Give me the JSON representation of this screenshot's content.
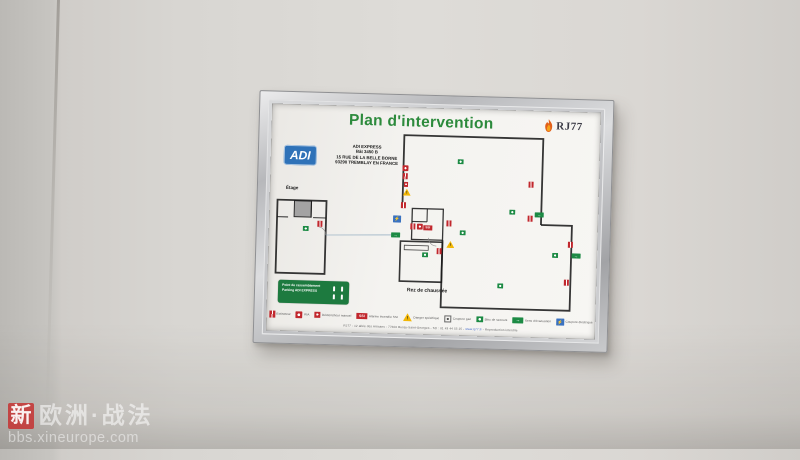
{
  "watermark": {
    "badge": "新",
    "title": "欧洲·战法",
    "site": "bbs.xineurope.com"
  },
  "poster": {
    "title": "Plan d'intervention",
    "brand": {
      "name": "RJ77"
    },
    "site_block": {
      "logo": "ADI",
      "lines": [
        "ADI EXPRESS",
        "Bât 3450 B",
        "15 RUE DE LA BELLE BORNE",
        "93290 TREMBLAY EN FRANCE"
      ]
    },
    "labels": {
      "upper_floor": "Étage",
      "ground_floor": "Rez de chaussée"
    },
    "assembly_box": {
      "line1": "Point de rassemblement",
      "line2": "Parking ADI EXPRESS"
    },
    "legend": {
      "items": [
        {
          "id": "extinguisher",
          "label": "Extincteur"
        },
        {
          "id": "hose-reel",
          "label": "RIA"
        },
        {
          "id": "manual-call-point",
          "label": "Déclencheur manuel"
        },
        {
          "id": "ssi",
          "label": "Alarme incendie SSI"
        },
        {
          "id": "danger",
          "label": "Danger spécifique"
        },
        {
          "id": "gas-cutoff",
          "label": "Coupure gaz"
        },
        {
          "id": "emergency-block",
          "label": "Bloc de secours"
        },
        {
          "id": "evacuation-direction",
          "label": "Sens d'évacuation"
        },
        {
          "id": "electric-cutoff",
          "label": "Coupure électrique"
        }
      ]
    },
    "footer": {
      "prefix": "RJ77 - 12 allée des Artisans - 77600 Bussy-Saint-Georges - Tél : 01 43 44 55 25 - ",
      "link": "www.rj77.fr",
      "suffix": " - Reproduction interdite"
    },
    "plan_markers": [
      {
        "t": "ext",
        "x": 51,
        "y": 119
      },
      {
        "t": "block",
        "x": 37,
        "y": 124
      },
      {
        "t": "block",
        "x": 190,
        "y": 53
      },
      {
        "t": "ria",
        "x": 135,
        "y": 61
      },
      {
        "t": "ext",
        "x": 135,
        "y": 69
      },
      {
        "t": "dm",
        "x": 136,
        "y": 77
      },
      {
        "t": "danger",
        "x": 137,
        "y": 85
      },
      {
        "t": "ext",
        "x": 134,
        "y": 98
      },
      {
        "t": "elec",
        "x": 128,
        "y": 112
      },
      {
        "t": "exit",
        "x": 127,
        "y": 128
      },
      {
        "t": "ext",
        "x": 144,
        "y": 119
      },
      {
        "t": "ria",
        "x": 151,
        "y": 119
      },
      {
        "t": "ssi",
        "x": 159,
        "y": 120
      },
      {
        "t": "ext",
        "x": 180,
        "y": 115
      },
      {
        "t": "block",
        "x": 194,
        "y": 124
      },
      {
        "t": "danger",
        "x": 182,
        "y": 136
      },
      {
        "t": "ext",
        "x": 171,
        "y": 143
      },
      {
        "t": "block",
        "x": 157,
        "y": 147
      },
      {
        "t": "block",
        "x": 243,
        "y": 102
      },
      {
        "t": "ext",
        "x": 261,
        "y": 74
      },
      {
        "t": "ext",
        "x": 261,
        "y": 108
      },
      {
        "t": "exit",
        "x": 270,
        "y": 104
      },
      {
        "t": "ext",
        "x": 302,
        "y": 133
      },
      {
        "t": "exit",
        "x": 308,
        "y": 144
      },
      {
        "t": "block",
        "x": 287,
        "y": 144
      },
      {
        "t": "ext",
        "x": 299,
        "y": 171
      },
      {
        "t": "block",
        "x": 233,
        "y": 176
      }
    ],
    "colors": {
      "title_green": "#2c8a3c",
      "safety_red": "#c1272d",
      "safety_green": "#1c8a44",
      "warning_yellow": "#f2b705",
      "electric_blue": "#3a72c0",
      "adi_blue": "#2f72b8"
    }
  }
}
